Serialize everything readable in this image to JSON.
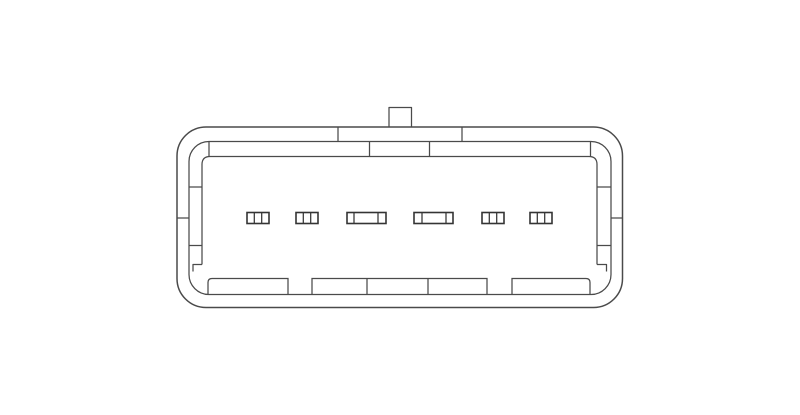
{
  "page": {
    "background_color": "#ffffff",
    "width": 800,
    "height": 415
  },
  "diagram": {
    "kind": "technical-line-drawing",
    "subject": "6-terminal rectangular connector, mating face view",
    "terminal_count": 6,
    "line_color": "#4a4a4a",
    "pin_line_color": "#343434",
    "fill_color": "none",
    "stroke_width_main": 1.25,
    "stroke_width_outer": 1.5,
    "stroke_width_pin": 1.6,
    "outer_shell": {
      "x": 177,
      "y": 127,
      "w": 445.5,
      "h": 180.5,
      "r": 29
    },
    "inner_shell": {
      "x": 189,
      "y": 141.5,
      "w": 422,
      "h": 153,
      "r": 20
    },
    "cavity": {
      "left_x": 202,
      "right_x": 597,
      "top_y": 156.5,
      "corner_r": 8,
      "side_end_y": 264.5
    },
    "key_tab": {
      "x": 389,
      "y": 107.5,
      "w": 22.5,
      "h": 20
    },
    "top_outer_band": {
      "y1": 127,
      "y2": 141.5,
      "divider_x": [
        338,
        462
      ]
    },
    "top_inner_band": {
      "y1": 141.5,
      "y2": 156.5,
      "divider_x": [
        369.5,
        429.5
      ],
      "tangent_tick_x": [
        209,
        590.5
      ]
    },
    "side_ticks": {
      "inner_band_y": [
        187,
        245.5
      ],
      "outer_band_y": [
        218
      ],
      "left_inner_band_x": [
        189,
        202
      ],
      "right_inner_band_x": [
        597,
        611
      ],
      "left_outer_band_x": [
        177,
        189
      ],
      "right_outer_band_x": [
        611,
        622.5
      ]
    },
    "bottom_steps": {
      "left_points": [
        [
          202,
          264.5
        ],
        [
          193,
          264.5
        ],
        [
          193,
          271.5
        ]
      ],
      "right_points": [
        [
          597,
          264.5
        ],
        [
          606.5,
          264.5
        ],
        [
          606.5,
          271.5
        ]
      ]
    },
    "bottom_band": {
      "top_y": 278.5,
      "bottom_y": 294.5,
      "corner_r": 4
    },
    "bottom_blocks": [
      {
        "x1": 208,
        "x2": 288,
        "dividers": [],
        "round": "left"
      },
      {
        "x1": 312,
        "x2": 487,
        "dividers": [
          367,
          428
        ],
        "round": "none"
      },
      {
        "x1": 512,
        "x2": 590,
        "dividers": [],
        "round": "right"
      }
    ],
    "pin_row": {
      "y": 212.5,
      "h": 11
    },
    "pins": [
      {
        "x1": 247,
        "x2": 269,
        "dividers": [
          254.3,
          261.7
        ]
      },
      {
        "x1": 296,
        "x2": 318,
        "dividers": [
          303.3,
          310.7
        ]
      },
      {
        "x1": 347,
        "x2": 386,
        "dividers": [
          354,
          378
        ]
      },
      {
        "x1": 414,
        "x2": 453,
        "dividers": [
          422,
          446
        ]
      },
      {
        "x1": 482,
        "x2": 504,
        "dividers": [
          489.3,
          496.7
        ]
      },
      {
        "x1": 530,
        "x2": 552,
        "dividers": [
          537.3,
          544.7
        ]
      }
    ]
  }
}
